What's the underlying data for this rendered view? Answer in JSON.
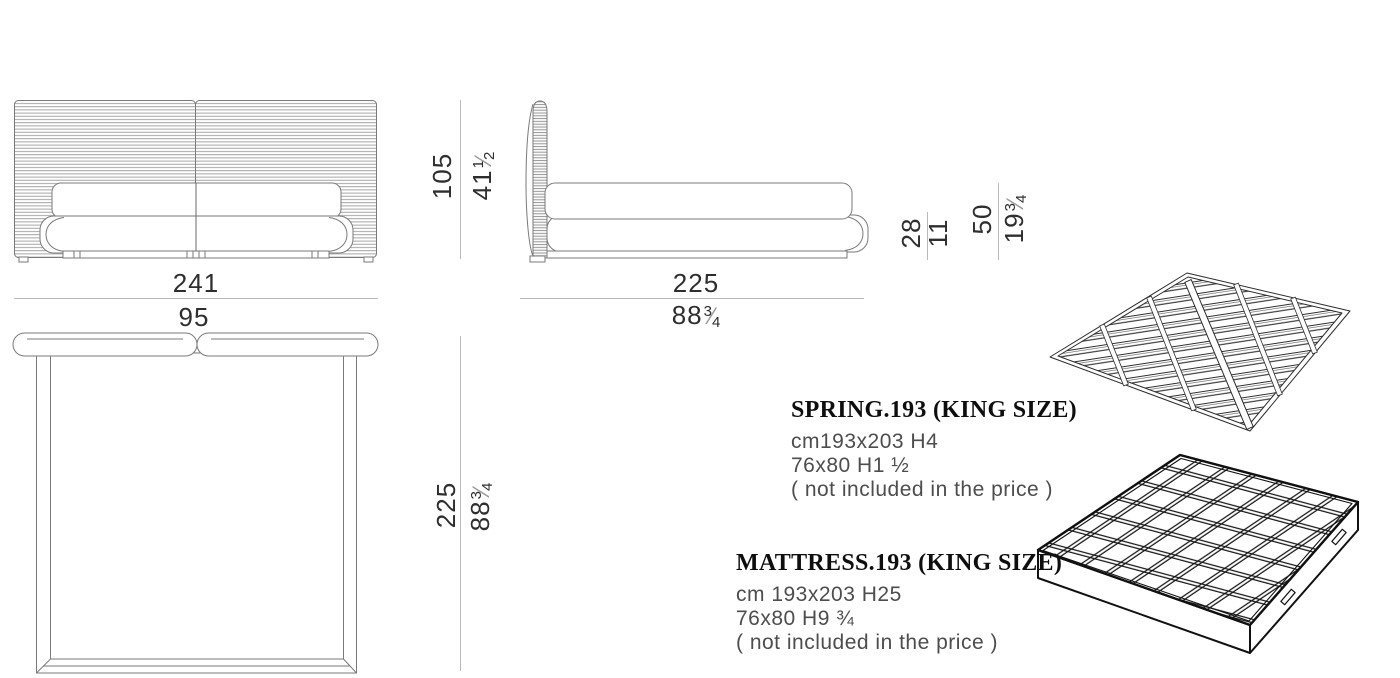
{
  "palette": {
    "background": "#ffffff",
    "drawing_line": "#7a7a7a",
    "hatch_line": "#9b9b9b",
    "dimension_line": "#b8b8b8",
    "dimension_text": "#2e2e2e",
    "title_text": "#0e0e0e",
    "spec_text": "#4d4d4d",
    "illustration_line": "#1a1a1a"
  },
  "symbols": {
    "fraction_slash": "⁄"
  },
  "dimensions": {
    "front_width": {
      "cm": "241",
      "inch": "95"
    },
    "bed_height": {
      "cm": "105",
      "inch_whole": "41",
      "inch_num": "1",
      "inch_den": "2"
    },
    "bed_depth_side": {
      "cm": "225",
      "inch_whole": "88",
      "inch_num": "3",
      "inch_den": "4"
    },
    "frame_height": {
      "cm": "28",
      "inch": "11"
    },
    "mattress_top_height": {
      "cm": "50",
      "inch_whole": "19",
      "inch_num": "3",
      "inch_den": "4"
    },
    "bed_depth_top": {
      "cm": "225",
      "inch_whole": "88",
      "inch_num": "3",
      "inch_den": "4"
    }
  },
  "products": {
    "spring": {
      "title": "SPRING.193 (KING SIZE)",
      "size_cm": "cm193x203 H4",
      "size_in": "76x80 H1 ½",
      "note": "( not included in the price )"
    },
    "mattress": {
      "title": "MATTRESS.193 (KING SIZE)",
      "size_cm": "cm 193x203 H25",
      "size_in": "76x80 H9 ¾",
      "note": "( not included in the price )"
    }
  }
}
